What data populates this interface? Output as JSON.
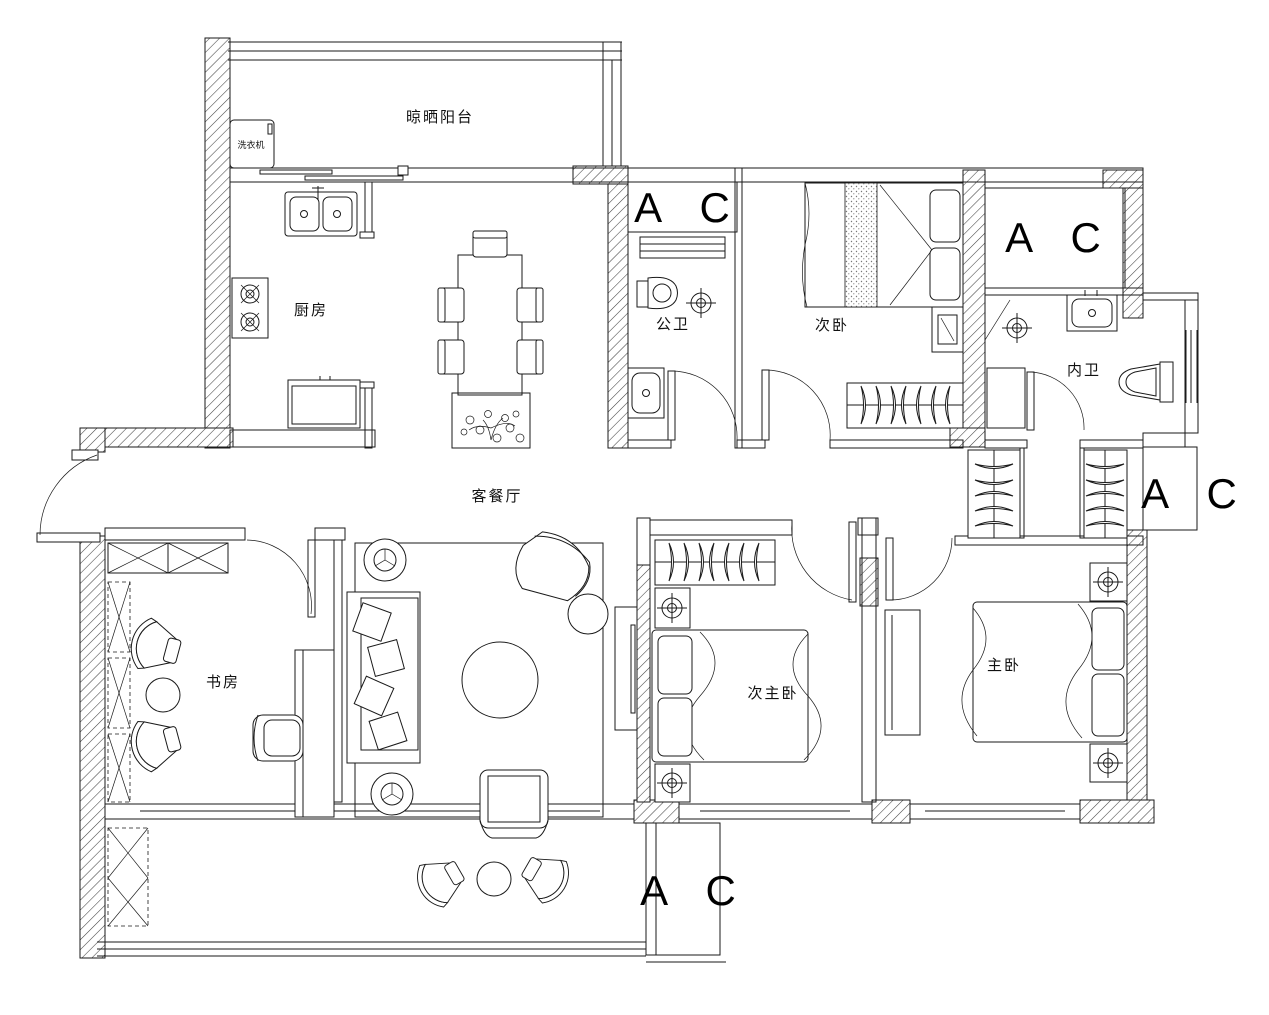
{
  "colors": {
    "background": "#ffffff",
    "line": "#1a1a1a",
    "text": "#000000"
  },
  "labels": {
    "drying_balcony": "晾晒阳台",
    "washing_machine": "洗衣机",
    "kitchen": "厨房",
    "public_bathroom": "公卫",
    "secondary_bedroom": "次卧",
    "ensuite_bathroom": "内卫",
    "living_dining": "客餐厅",
    "study": "书房",
    "junior_master_bedroom": "次主卧",
    "master_bedroom": "主卧"
  },
  "ac_label": "A C"
}
